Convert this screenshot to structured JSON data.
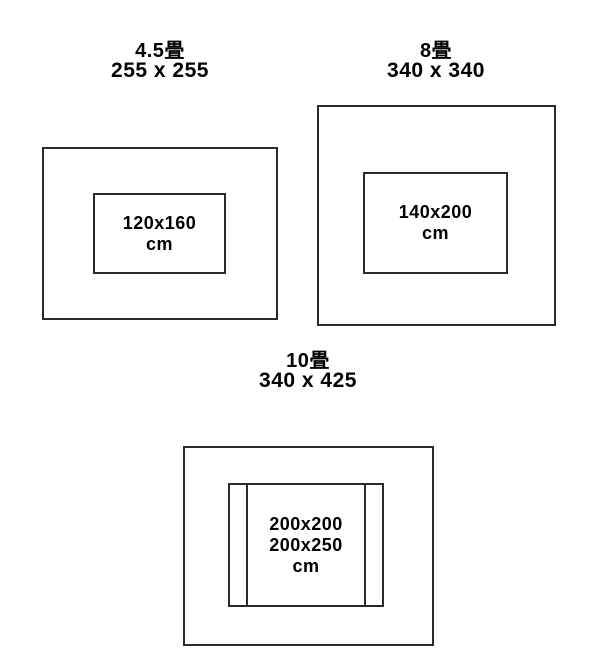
{
  "canvas": {
    "background": "#ffffff",
    "line_color": "#2b2b2b",
    "text_color": "#000000"
  },
  "diagrams": [
    {
      "title": "4.5畳",
      "room_size": "255 x 255",
      "rug_lines": [
        "120x160",
        "cm"
      ]
    },
    {
      "title": "8畳",
      "room_size": "340 x 340",
      "rug_lines": [
        "140x200",
        "cm"
      ]
    },
    {
      "title": "10畳",
      "room_size": "340 x 425",
      "rug_lines": [
        "200x200",
        "200x250",
        "cm"
      ]
    }
  ]
}
